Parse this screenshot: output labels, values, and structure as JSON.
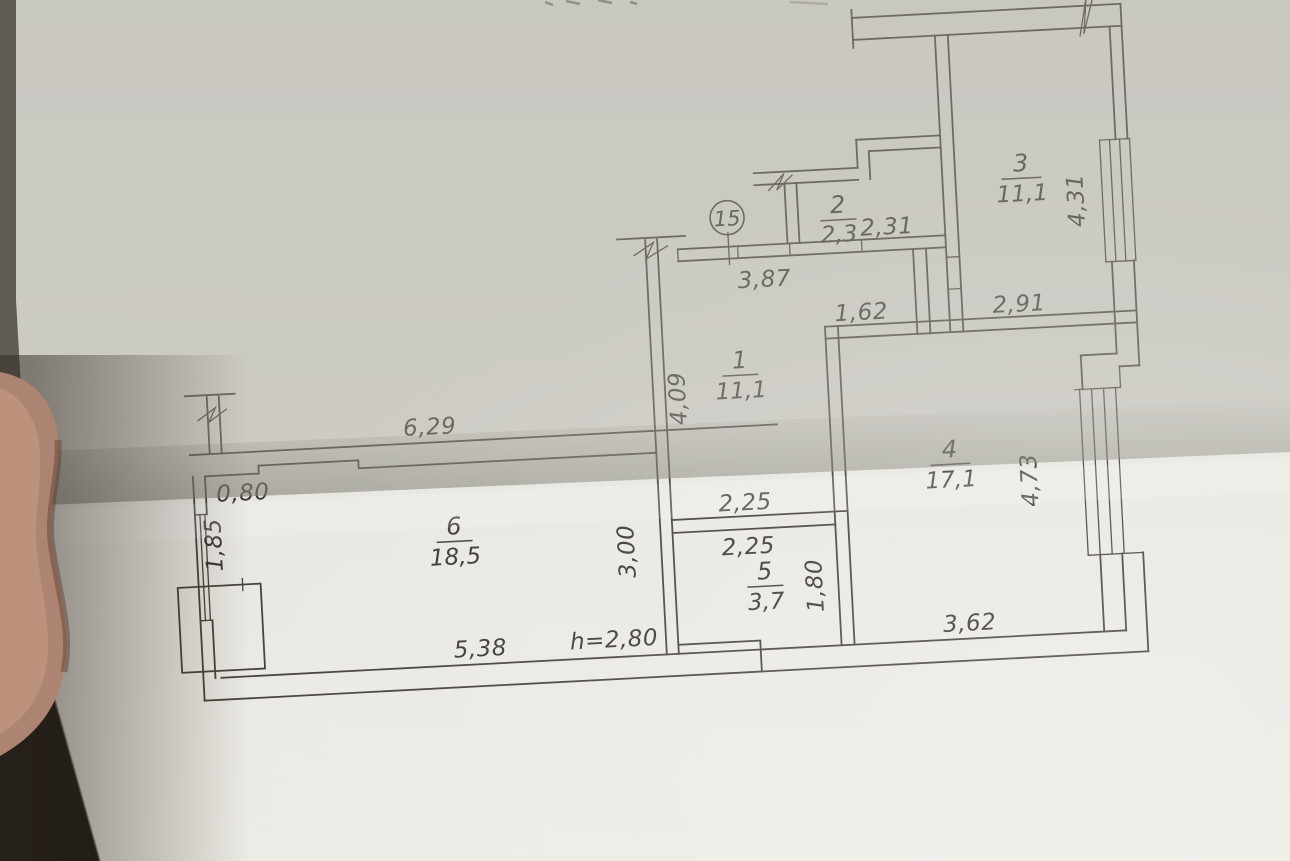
{
  "plan": {
    "unit_number": "15",
    "rooms": [
      {
        "number": "1",
        "area": "11,1"
      },
      {
        "number": "2",
        "area": "2,3"
      },
      {
        "number": "3",
        "area": "11,1"
      },
      {
        "number": "4",
        "area": "17,1"
      },
      {
        "number": "5",
        "area": "3,7"
      },
      {
        "number": "6",
        "area": "18,5"
      }
    ],
    "dims": {
      "d629": "6,29",
      "d080": "0,80",
      "d185": "1,85",
      "d538": "5,38",
      "dh280": "h=2,80",
      "d300": "3,00",
      "d225a": "2,25",
      "d225b": "2,25",
      "d180": "1,80",
      "d362": "3,62",
      "d387": "3,87",
      "d409": "4,09",
      "d162": "1,62",
      "d291": "2,91",
      "d231": "2,31",
      "d431": "4,31",
      "d473": "4,73"
    },
    "colors": {
      "ink": "#3b3733",
      "paper_lower": "#e9e7e2",
      "paper_upper": "#cbcbc4",
      "background": "#1c1712",
      "finger": "#b08874"
    }
  }
}
